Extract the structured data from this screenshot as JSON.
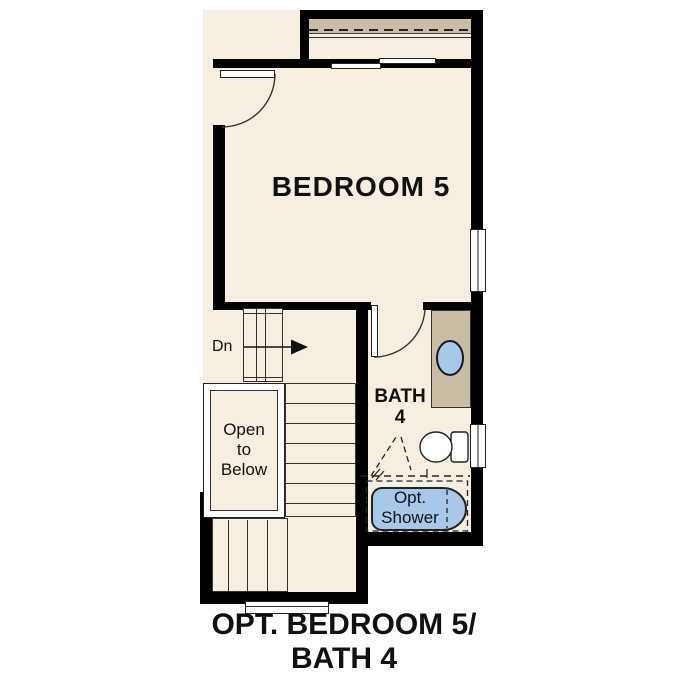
{
  "labels": {
    "bedroom": "BEDROOM 5",
    "bath_line1": "BATH",
    "bath_line2": "4",
    "stairs_down": "Dn",
    "open_to_below_line1": "Open",
    "open_to_below_line2": "to",
    "open_to_below_line3": "Below",
    "shower_line1": "Opt.",
    "shower_line2": "Shower"
  },
  "caption": {
    "line1": "OPT. BEDROOM 5/",
    "line2": "BATH 4"
  },
  "icons": {
    "sink": "sink-basin-icon",
    "toilet": "toilet-icon",
    "shower_tub": "optional-shower-tub-icon",
    "down_arrow": "stairs-down-arrow-icon",
    "closet_shelf": "closet-shelf-dashed-rod"
  },
  "colors": {
    "background": "#ffffff",
    "floor": "#f5eee1",
    "wall": "#000000",
    "casework_tan": "#c9bda6",
    "fixture_blue": "#a8c8ea",
    "linework": "#333333",
    "text": "#111111"
  }
}
